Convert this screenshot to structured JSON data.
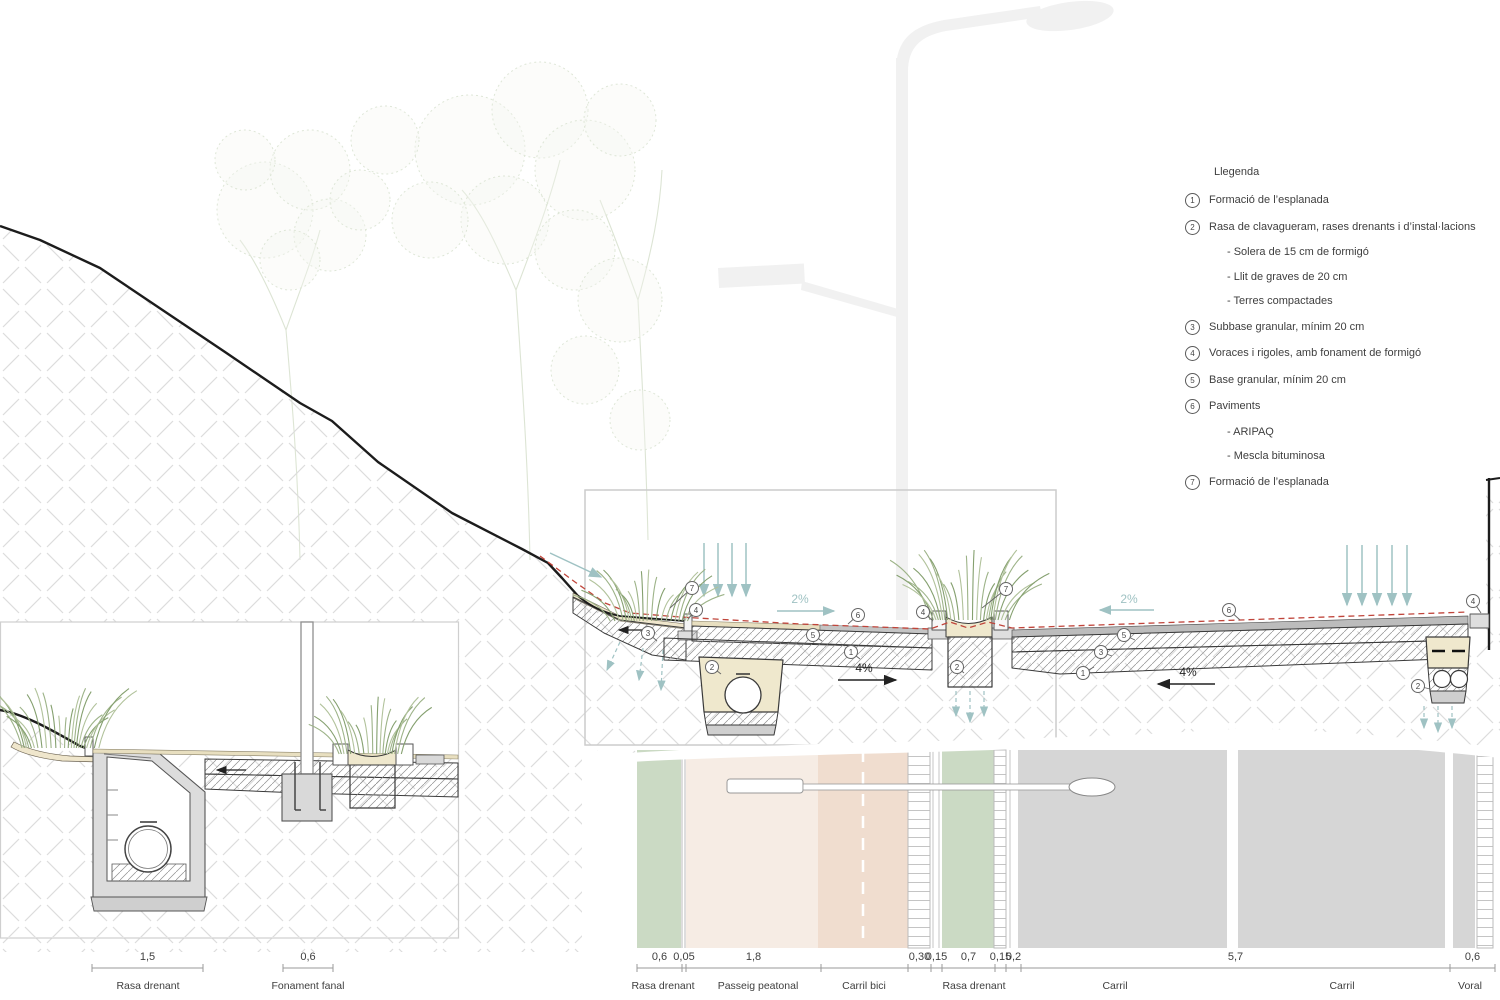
{
  "legend": {
    "title": "Llegenda",
    "items": [
      {
        "num": "1",
        "text": "Formació de l’esplanada",
        "subs": []
      },
      {
        "num": "2",
        "text": "Rasa de clavagueram, rases drenants i d’instal·lacions",
        "subs": [
          "- Solera de 15 cm de formigó",
          "- Llit de graves de 20 cm",
          "- Terres compactades"
        ]
      },
      {
        "num": "3",
        "text": "Subbase granular, mínim 20 cm",
        "subs": []
      },
      {
        "num": "4",
        "text": "Voraces i rigoles, amb fonament de formigó",
        "subs": []
      },
      {
        "num": "5",
        "text": "Base granular, mínim 20 cm",
        "subs": []
      },
      {
        "num": "6",
        "text": "Paviments",
        "subs": [
          "- ARIPAQ",
          "- Mescla bituminosa"
        ]
      },
      {
        "num": "7",
        "text": "Formació de l’esplanada",
        "subs": []
      }
    ]
  },
  "annotations": {
    "slope_arrows": [
      {
        "text": "2%",
        "tx": 800,
        "ty": 603,
        "x1": 777,
        "y1": 611,
        "x2": 834,
        "y2": 611,
        "color": "teal"
      },
      {
        "text": "2%",
        "tx": 1129,
        "ty": 603,
        "x1": 1154,
        "y1": 610,
        "x2": 1100,
        "y2": 610,
        "color": "teal"
      },
      {
        "text": "4%",
        "tx": 864,
        "ty": 672,
        "x1": 838,
        "y1": 680,
        "x2": 896,
        "y2": 680,
        "color": "black"
      },
      {
        "text": "4%",
        "tx": 1188,
        "ty": 676,
        "x1": 1215,
        "y1": 684,
        "x2": 1158,
        "y2": 684,
        "color": "black"
      }
    ],
    "callouts": [
      {
        "n": "7",
        "x": 692,
        "y": 588,
        "tx": 670,
        "ty": 608
      },
      {
        "n": "4",
        "x": 696,
        "y": 610,
        "tx": 688,
        "ty": 619
      },
      {
        "n": "3",
        "x": 648,
        "y": 633,
        "tx": 657,
        "ty": 641
      },
      {
        "n": "2",
        "x": 712,
        "y": 667,
        "tx": 721,
        "ty": 674
      },
      {
        "n": "6",
        "x": 858,
        "y": 615,
        "tx": 848,
        "ty": 624
      },
      {
        "n": "5",
        "x": 813,
        "y": 635,
        "tx": 822,
        "ty": 641
      },
      {
        "n": "1",
        "x": 851,
        "y": 652,
        "tx": 860,
        "ty": 659
      },
      {
        "n": "4",
        "x": 923,
        "y": 612,
        "tx": 933,
        "ty": 621
      },
      {
        "n": "7",
        "x": 1006,
        "y": 589,
        "tx": 982,
        "ty": 608
      },
      {
        "n": "2",
        "x": 957,
        "y": 667,
        "tx": 964,
        "ty": 673
      },
      {
        "n": "1",
        "x": 1083,
        "y": 673,
        "tx": 1094,
        "ty": 667
      },
      {
        "n": "3",
        "x": 1101,
        "y": 652,
        "tx": 1112,
        "ty": 656
      },
      {
        "n": "5",
        "x": 1124,
        "y": 635,
        "tx": 1135,
        "ty": 640
      },
      {
        "n": "6",
        "x": 1229,
        "y": 610,
        "tx": 1240,
        "ty": 620
      },
      {
        "n": "2",
        "x": 1418,
        "y": 686,
        "tx": 1430,
        "ty": 689
      },
      {
        "n": "4",
        "x": 1473,
        "y": 601,
        "tx": 1481,
        "ty": 613
      }
    ]
  },
  "dimensions": {
    "main": {
      "y_line": 968,
      "segments": [
        {
          "from": 637,
          "to": 682,
          "label": "0,6"
        },
        {
          "from": 682,
          "to": 686,
          "label": "0,05"
        },
        {
          "from": 686,
          "to": 821,
          "label": "1,8"
        },
        {
          "from": 821,
          "to": 908,
          "label": ""
        },
        {
          "from": 908,
          "to": 931,
          "label": "0,30"
        },
        {
          "from": 931,
          "to": 942,
          "label": "0,15"
        },
        {
          "from": 942,
          "to": 995,
          "label": "0,7"
        },
        {
          "from": 995,
          "to": 1006,
          "label": "0,15"
        },
        {
          "from": 1006,
          "to": 1021,
          "label": "0,2"
        },
        {
          "from": 1021,
          "to": 1450,
          "label": "5,7"
        },
        {
          "from": 1450,
          "to": 1495,
          "label": "0,6"
        }
      ],
      "zones": [
        {
          "x": 663,
          "label": "Rasa drenant"
        },
        {
          "x": 758,
          "label": "Passeig peatonal"
        },
        {
          "x": 864,
          "label": "Carril bici"
        },
        {
          "x": 974,
          "label": "Rasa drenant"
        },
        {
          "x": 1115,
          "label": "Carril"
        },
        {
          "x": 1342,
          "label": "Carril"
        },
        {
          "x": 1470,
          "label": "Voral"
        }
      ]
    },
    "inset": {
      "y_line": 968,
      "segments": [
        {
          "from": 92,
          "to": 203,
          "label": "1,5"
        },
        {
          "from": 283,
          "to": 333,
          "label": "0,6"
        }
      ],
      "zones": [
        {
          "x": 148,
          "label": "Rasa drenant"
        },
        {
          "x": 308,
          "label": "Fonament fanal"
        }
      ]
    }
  },
  "colors": {
    "teal": "#9fc2c3",
    "red_dashed": "#c0453b",
    "hatch_gray": "#dcdcdc",
    "sand": "#efe8cd",
    "tan_paving": "#e8dfc0",
    "green_band": "#cbdac4",
    "pink_walk": "#f6ece4",
    "pink_bike": "#f0ddcf",
    "gray_lane": "#d6d6d6",
    "grass": "#97ad81",
    "tree": "#c6d3b8",
    "lamp": "#f1f1f1"
  }
}
